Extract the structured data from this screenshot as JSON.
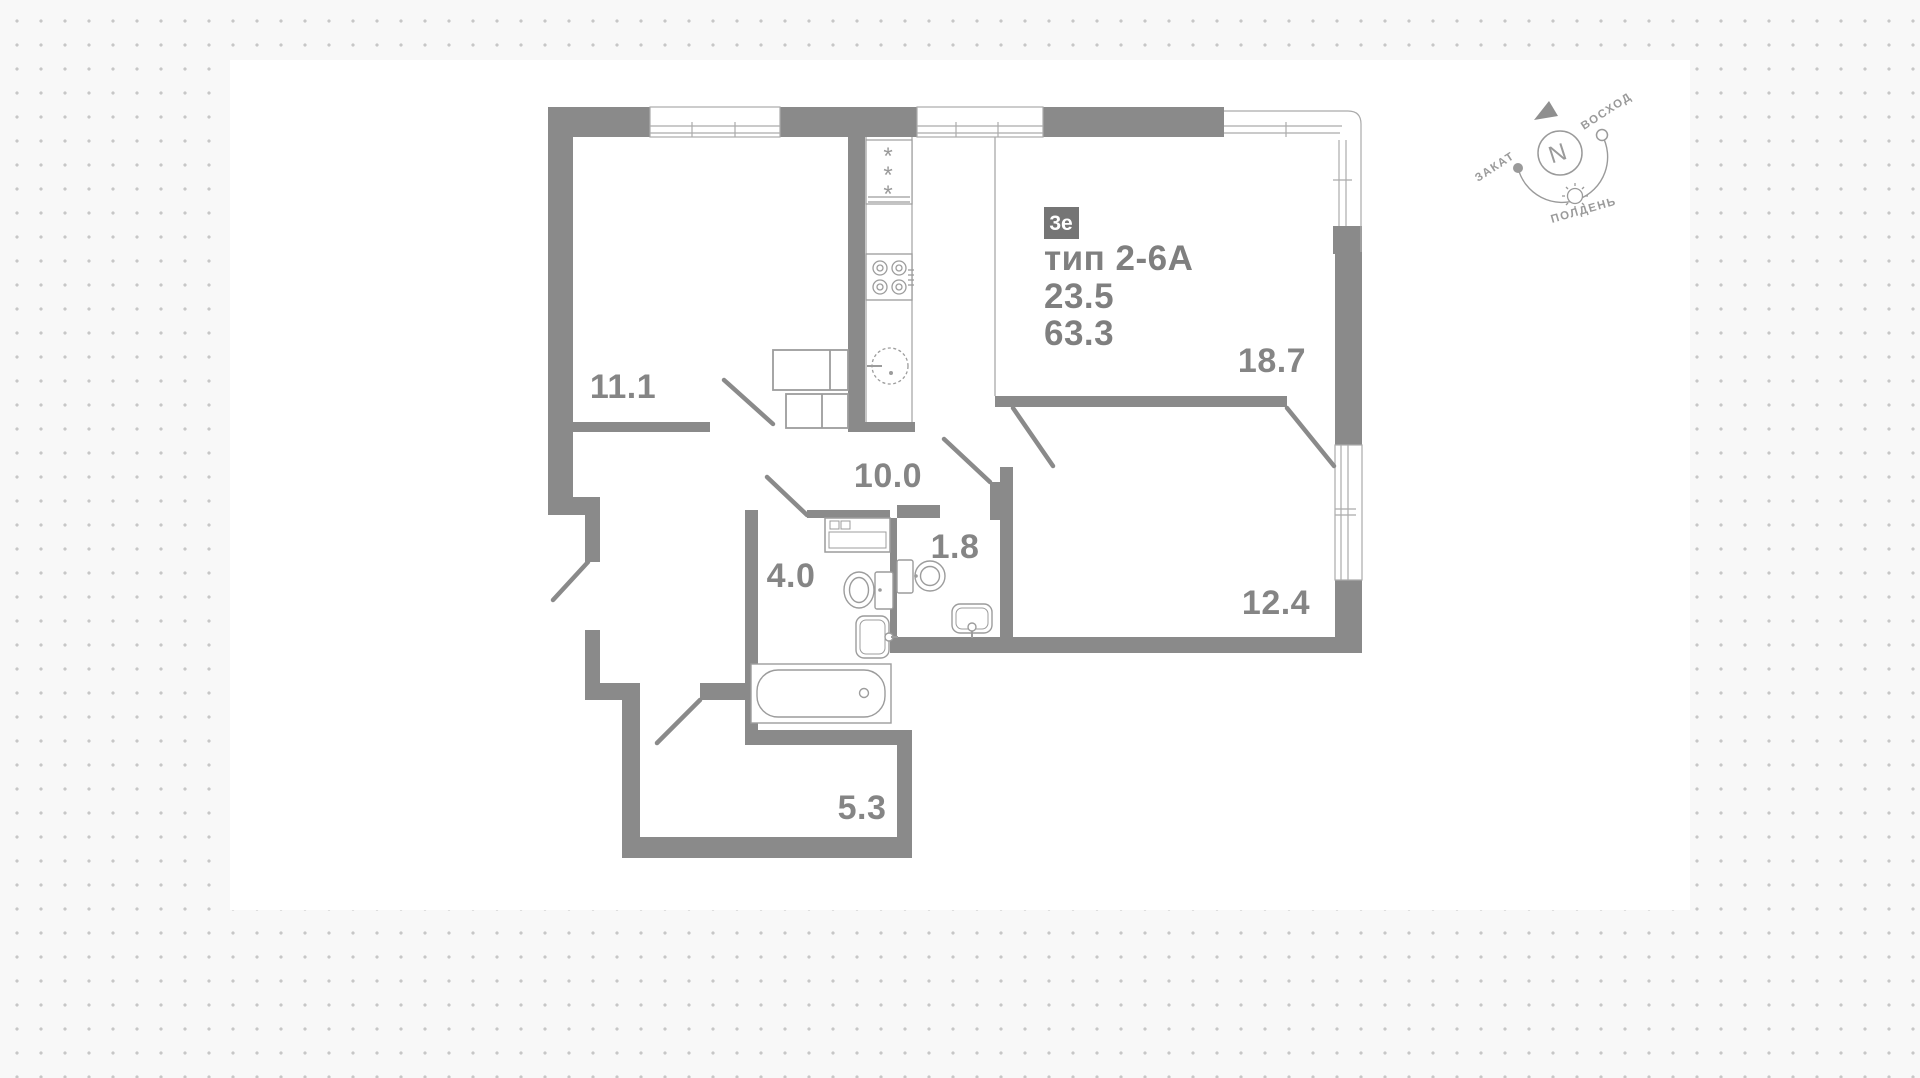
{
  "plan": {
    "badge": "3е",
    "type_label": "тип 2-6А",
    "area_value_1": "23.5",
    "area_value_2": "63.3",
    "rooms": [
      {
        "name": "room-11-1",
        "area": "11.1"
      },
      {
        "name": "living-18-7",
        "area": "18.7"
      },
      {
        "name": "corridor-10-0",
        "area": "10.0"
      },
      {
        "name": "bathroom-4-0",
        "area": "4.0"
      },
      {
        "name": "wc-1-8",
        "area": "1.8"
      },
      {
        "name": "bedroom-12-4",
        "area": "12.4"
      },
      {
        "name": "hall-5-3",
        "area": "5.3"
      }
    ]
  },
  "compass": {
    "north_letter": "N",
    "sunrise": "ВОСХОД",
    "sunset": "ЗАКАТ",
    "noon": "ПОЛДЕНЬ"
  },
  "colors": {
    "wall": "#8a8a8a",
    "thin_line": "#a9a9a9",
    "fixture_line": "#9c9c9c",
    "label_text": "#858585",
    "badge_bg": "#757575",
    "badge_text": "#ffffff",
    "background": "#f8f8f8",
    "dot": "#c7c7c7",
    "canvas": "#ffffff"
  }
}
